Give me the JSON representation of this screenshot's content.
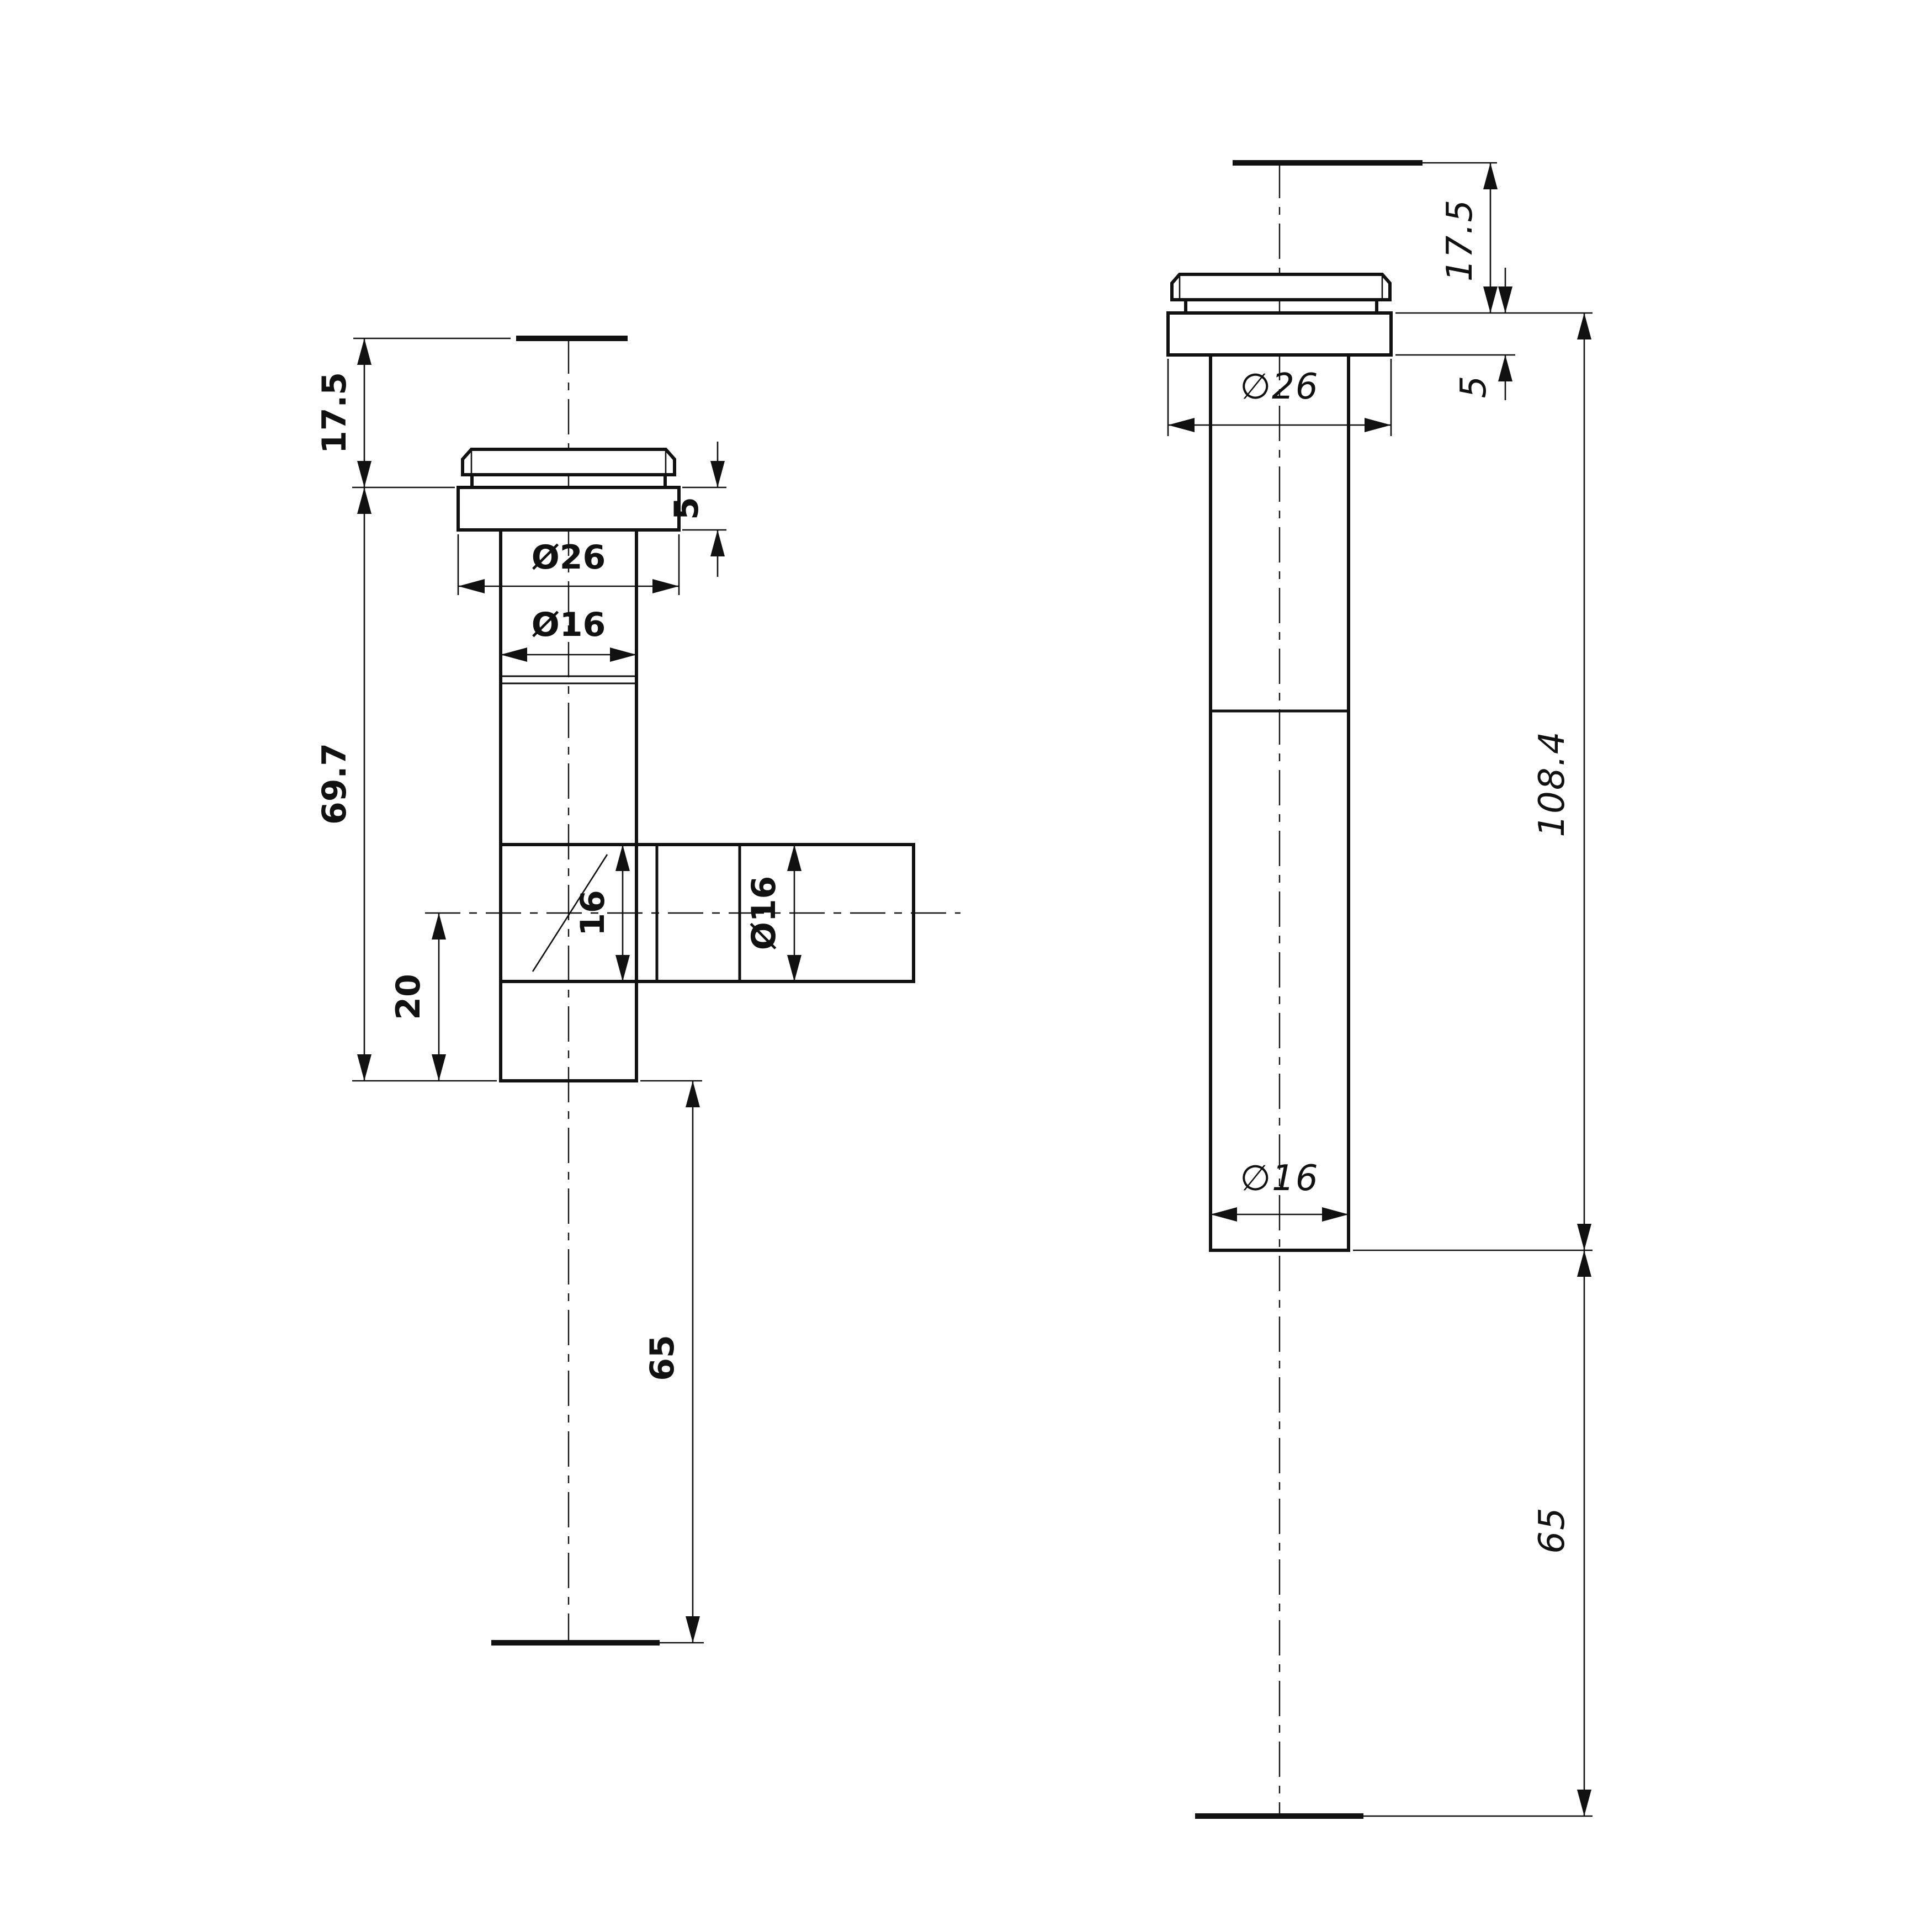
{
  "page": {
    "background": "#ffffff",
    "line_color": "#111111",
    "kind": "technical-drawing"
  },
  "front_view": {
    "dims": {
      "cap_height": "17.5",
      "body_length": "69.7",
      "flange_height": "5",
      "flange_dia": "Ø26",
      "shaft_dia": "Ø16",
      "branch_bore": "16",
      "branch_dia": "Ø16",
      "branch_offset": "20",
      "glass_gap": "65"
    }
  },
  "side_view": {
    "dims": {
      "cap_height": "17.5",
      "flange_dia": "∅26",
      "flange_height": "5",
      "shaft_dia": "∅16",
      "overall_length": "108.4",
      "glass_gap": "65"
    }
  }
}
